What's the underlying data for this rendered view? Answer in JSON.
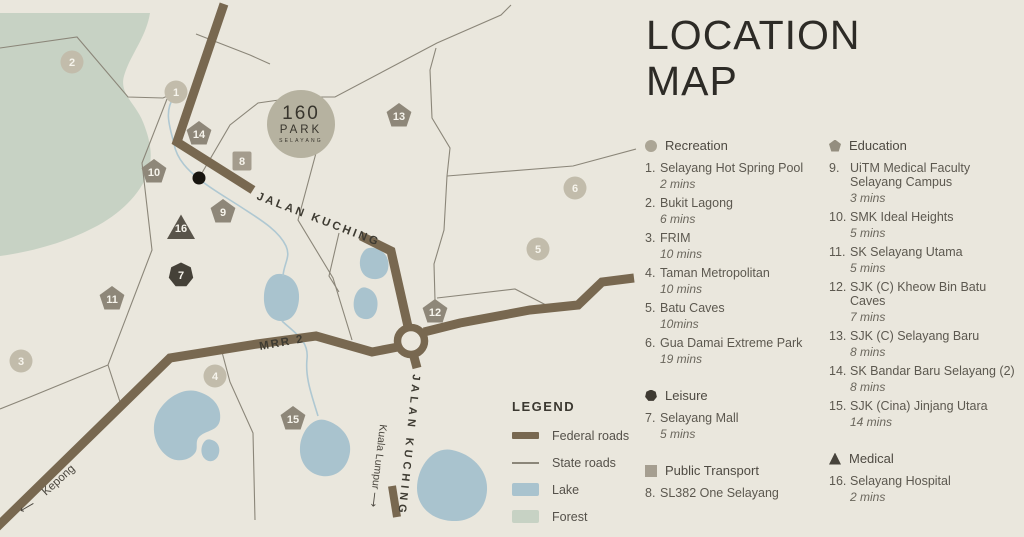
{
  "title": {
    "line1": "LOCATION",
    "line2": "MAP"
  },
  "logo": {
    "number": "160",
    "name": "PARK",
    "tagline": "SELAYANG"
  },
  "map": {
    "labels": {
      "jalan_kuching": "JALAN KUCHING",
      "mrr2": "MRR 2",
      "kepong": "Kepong",
      "kepong_arrow": "⟵",
      "kuala_lumpur": "Kuala Lumpur ⟶"
    },
    "colors": {
      "background": "#eae7dd",
      "forest": "#c7d2c4",
      "lake": "#a9c3ce",
      "federal_road": "#786850",
      "state_road": "#8b8679",
      "marker_circle": "#c2bcab",
      "marker_pentagon": "#8e8779",
      "marker_square": "#a49c8d",
      "marker_dark": "#454138"
    },
    "markers": [
      {
        "n": "1",
        "shape": "circle",
        "x": 176,
        "y": 92
      },
      {
        "n": "2",
        "shape": "circle",
        "x": 72,
        "y": 62
      },
      {
        "n": "3",
        "shape": "circle",
        "x": 21,
        "y": 361
      },
      {
        "n": "4",
        "shape": "circle",
        "x": 215,
        "y": 376
      },
      {
        "n": "5",
        "shape": "circle",
        "x": 538,
        "y": 249
      },
      {
        "n": "6",
        "shape": "circle",
        "x": 575,
        "y": 188
      },
      {
        "n": "7",
        "shape": "heptagon",
        "x": 181,
        "y": 275
      },
      {
        "n": "8",
        "shape": "square",
        "x": 242,
        "y": 161
      },
      {
        "n": "9",
        "shape": "pentagon",
        "x": 223,
        "y": 212
      },
      {
        "n": "10",
        "shape": "pentagon",
        "x": 154,
        "y": 172
      },
      {
        "n": "11",
        "shape": "pentagon",
        "x": 112,
        "y": 299
      },
      {
        "n": "12",
        "shape": "pentagon",
        "x": 435,
        "y": 312
      },
      {
        "n": "13",
        "shape": "pentagon",
        "x": 399,
        "y": 116
      },
      {
        "n": "14",
        "shape": "pentagon",
        "x": 199,
        "y": 134
      },
      {
        "n": "15",
        "shape": "pentagon",
        "x": 293,
        "y": 419
      },
      {
        "n": "16",
        "shape": "triangle",
        "x": 181,
        "y": 228
      }
    ]
  },
  "legend": {
    "heading": "LEGEND",
    "items": [
      {
        "label": "Federal roads",
        "swatch": "federal"
      },
      {
        "label": "State roads",
        "swatch": "state"
      },
      {
        "label": "Lake",
        "swatch": "lake"
      },
      {
        "label": "Forest",
        "swatch": "forest"
      }
    ]
  },
  "categories": [
    {
      "name": "Recreation",
      "icon": "circle",
      "column": 1,
      "items": [
        {
          "no": "1.",
          "name": "Selayang Hot Spring Pool",
          "time": "2 mins"
        },
        {
          "no": "2.",
          "name": "Bukit Lagong",
          "time": "6 mins"
        },
        {
          "no": "3.",
          "name": "FRIM",
          "time": "10 mins"
        },
        {
          "no": "4.",
          "name": "Taman Metropolitan",
          "time": "10 mins"
        },
        {
          "no": "5.",
          "name": "Batu Caves",
          "time": "10mins"
        },
        {
          "no": "6.",
          "name": "Gua Damai Extreme Park",
          "time": "19 mins"
        }
      ]
    },
    {
      "name": "Leisure",
      "icon": "heptagon",
      "column": 1,
      "items": [
        {
          "no": "7.",
          "name": "Selayang Mall",
          "time": "5 mins"
        }
      ]
    },
    {
      "name": "Public Transport",
      "icon": "square",
      "column": 1,
      "items": [
        {
          "no": "8.",
          "name": "SL382 One Selayang",
          "time": ""
        }
      ]
    },
    {
      "name": "Education",
      "icon": "pentagon",
      "column": 2,
      "items": [
        {
          "no": "9.",
          "name": "UiTM Medical Faculty Selayang Campus",
          "time": "3 mins"
        },
        {
          "no": "10.",
          "name": "SMK Ideal Heights",
          "time": "5 mins"
        },
        {
          "no": "11.",
          "name": "SK Selayang Utama",
          "time": "5 mins"
        },
        {
          "no": "12.",
          "name": "SJK (C) Kheow Bin Batu Caves",
          "time": "7 mins"
        },
        {
          "no": "13.",
          "name": "SJK (C) Selayang Baru",
          "time": "8 mins"
        },
        {
          "no": "14.",
          "name": "SK Bandar Baru Selayang (2)",
          "time": "8 mins"
        },
        {
          "no": "15.",
          "name": "SJK (Cina) Jinjang Utara",
          "time": "14 mins"
        }
      ]
    },
    {
      "name": "Medical",
      "icon": "triangle",
      "column": 2,
      "items": [
        {
          "no": "16.",
          "name": "Selayang Hospital",
          "time": "2 mins"
        }
      ]
    }
  ]
}
